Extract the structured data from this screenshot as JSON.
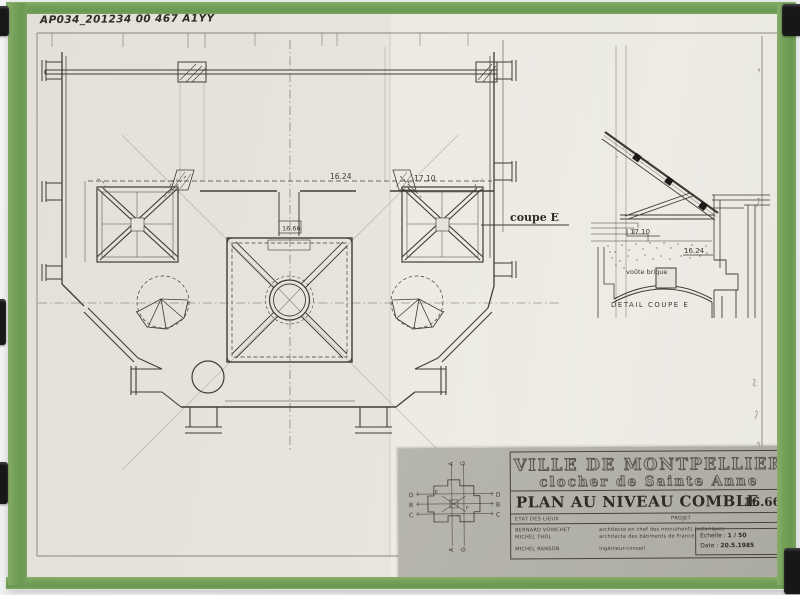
{
  "photo": {
    "tape_color": "#74a15a",
    "paper_color": "#e6e3da",
    "card_color": "#b1b0a7",
    "ink_color": "#3f3c35",
    "clip_color": "#17171a"
  },
  "archive_label": "AP034_201234 00 467 A1YY",
  "plan": {
    "dim_top_left": "16.24",
    "dim_top_right": "17.10",
    "dim_center": "16.66",
    "section_label": "coupe E"
  },
  "detail": {
    "level_upper": "17.10",
    "level_lower": "16.24",
    "vault_note": "voûte brique",
    "caption": "DETAIL COUPE E"
  },
  "titleblock": {
    "city": "VILLE DE MONTPELLIER",
    "subtitle": "clocher de Sainte Anne",
    "sheet_title": "PLAN AU NIVEAU COMBLE",
    "level": "16.66",
    "status_left": "ETAT DES LIEUX",
    "status_right": "PROJET",
    "team": [
      {
        "name": "BERNARD VOINCHET",
        "role": "architecte en chef des monuments historiques"
      },
      {
        "name": "MICHEL THOL",
        "role": "architecte des bâtiments de France"
      },
      {
        "name": "MICHEL RANSON",
        "role": "ingénieur-conseil"
      }
    ],
    "scale_label": "Echelle :",
    "scale_value": "1 / 50",
    "date_label": "Date :",
    "date_value": "20.5.1985",
    "keyplan": {
      "a": "A",
      "g": "G",
      "d": "D",
      "b": "B",
      "c": "C",
      "e": "E",
      "f": "F"
    }
  }
}
